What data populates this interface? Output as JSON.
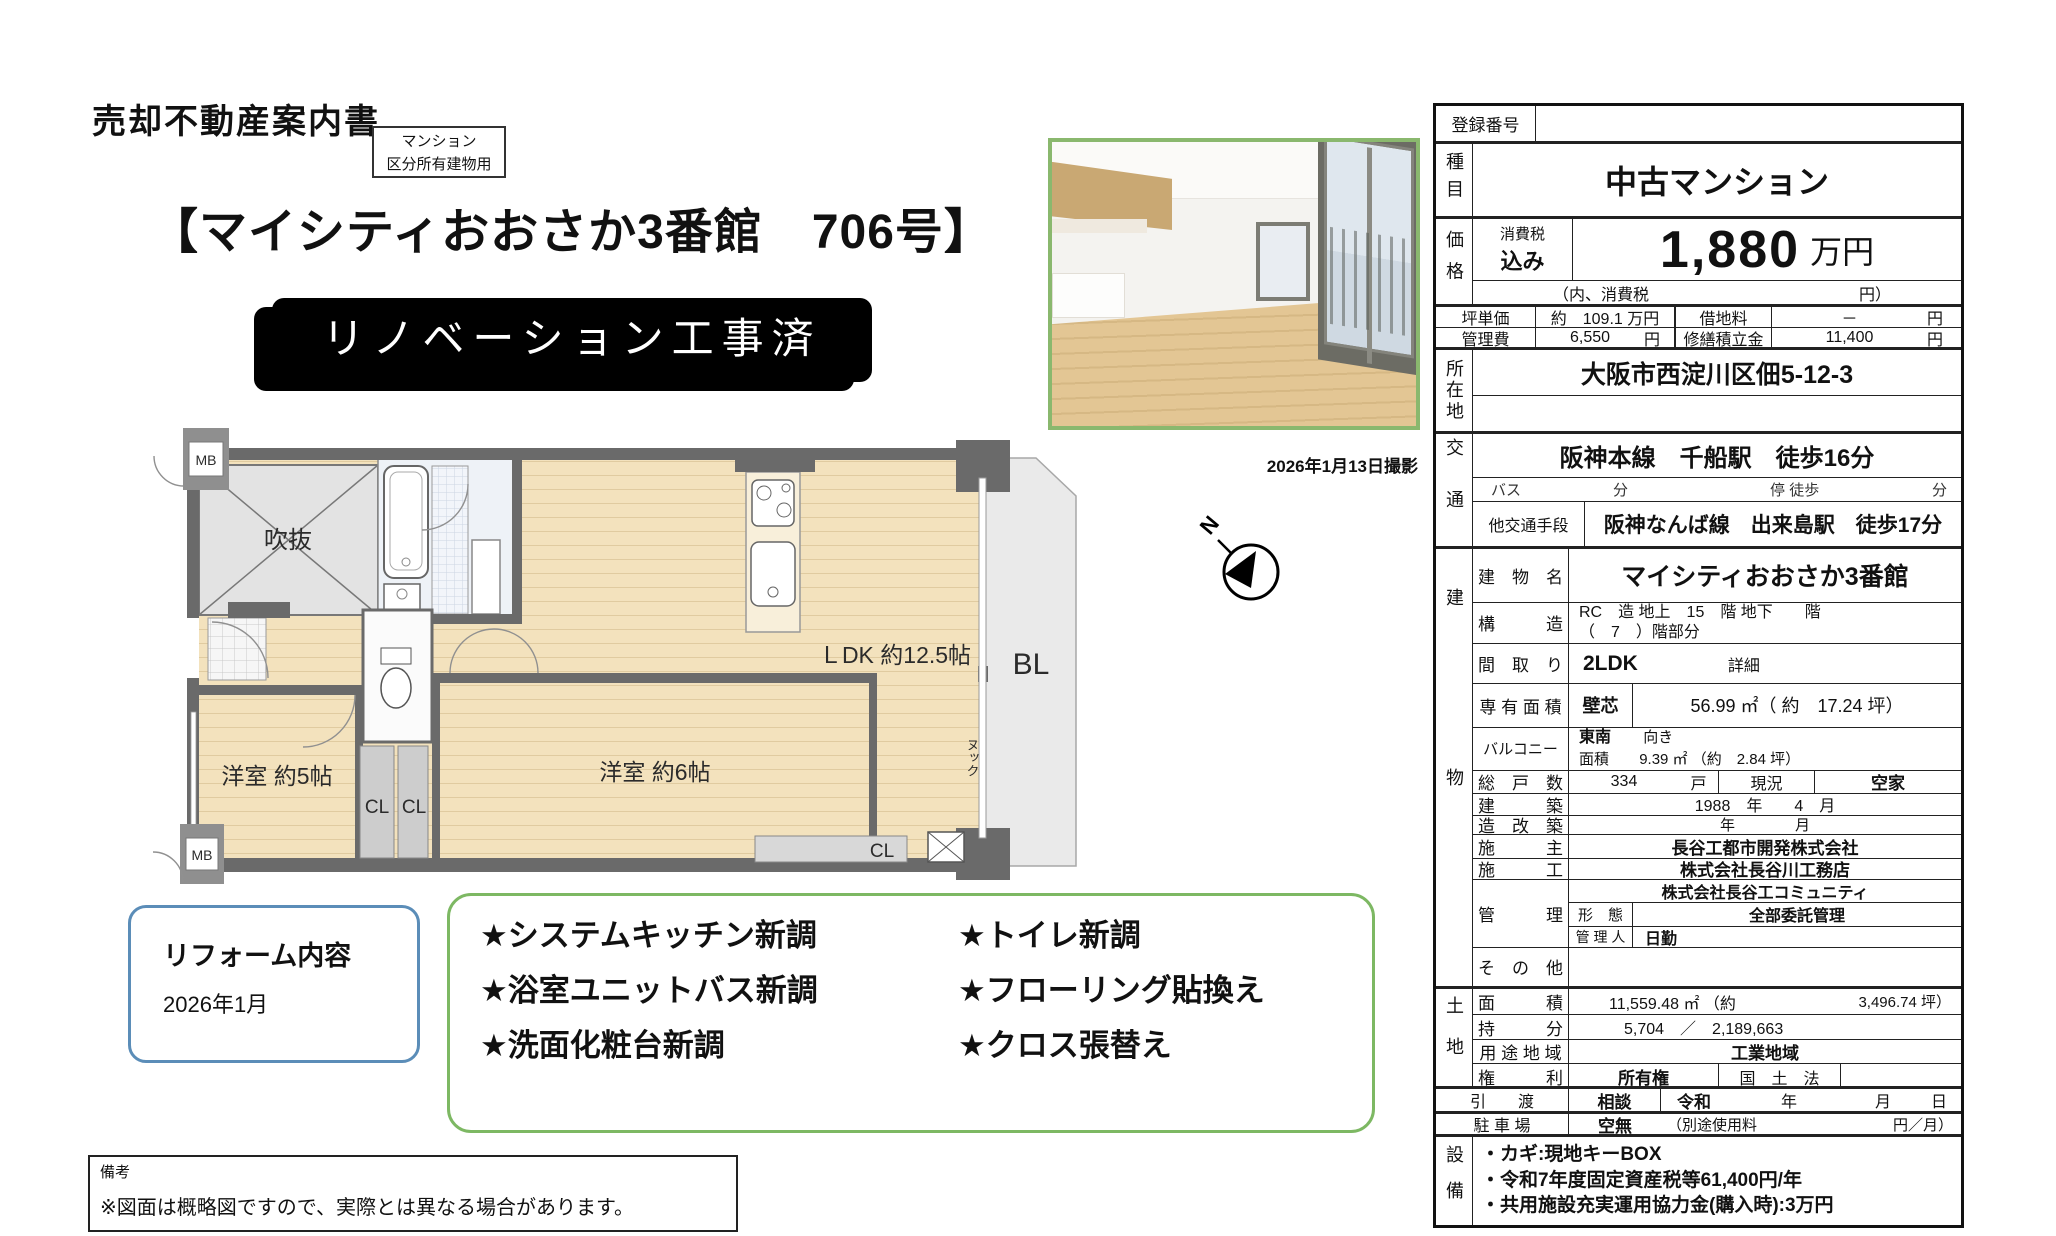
{
  "page": {
    "doc_title": "売却不動産案内書",
    "type_box": {
      "line1": "マンション",
      "line2": "区分所有建物用"
    },
    "heading": "【マイシティおおさか3番館　706号】",
    "banner": "リノベーション工事済",
    "photo_caption": "2026年1月13日撮影",
    "compass_n": "N"
  },
  "floorplan": {
    "labels": {
      "mb_top": "MB",
      "void": "吹抜",
      "bedroom5": "洋室 約5帖",
      "cl_left": "CL",
      "cl_right": "CL",
      "bedroom6": "洋室 約6帖",
      "ldk": "ＬDK 約12.5帖",
      "balcony": "BL",
      "nook": "ヌック",
      "cl_bottom": "CL",
      "mb_bottom": "MB"
    }
  },
  "reform": {
    "title": "リフォーム内容",
    "date": "2026年1月",
    "items": [
      "★システムキッチン新調",
      "★トイレ新調",
      "★浴室ユニットバス新調",
      "★フローリング貼換え",
      "★洗面化粧台新調",
      "★クロス張替え"
    ]
  },
  "remarks": {
    "label": "備考",
    "text": "※図面は概略図ですので、実際とは異なる場合があります。"
  },
  "table": {
    "registration": {
      "label": "登録番号",
      "value": ""
    },
    "category": {
      "label": "種目",
      "value": "中古マンション"
    },
    "price": {
      "label": "価格",
      "tax1": "消費税",
      "tax2": "込み",
      "value": "1,880",
      "unit": "万円",
      "note_left": "（内、消費税",
      "note_right": "円）"
    },
    "unit_price": {
      "label": "坪単価",
      "value": "約　109.1 万円"
    },
    "land_rent": {
      "label": "借地料",
      "value": "－",
      "unit": "円"
    },
    "mgmt_fee": {
      "label": "管理費",
      "value": "6,550",
      "unit": "円"
    },
    "repair_fund": {
      "label": "修繕積立金",
      "value": "11,400",
      "unit": "円"
    },
    "location": {
      "label": "所在地",
      "value": "大阪市西淀川区佃5-12-3"
    },
    "transport": {
      "label": "交通",
      "main": "阪神本線　千船駅　徒歩16分",
      "bus_label": "バス",
      "bus_min": "分",
      "bus_stop": "停 徒歩",
      "bus_stop_min": "分",
      "other_label": "他交通手段",
      "other": "阪神なんば線　出来島駅　徒歩17分"
    },
    "building": {
      "label": "建物",
      "name": {
        "label": "建　物　名",
        "value": "マイシティおおさか3番館"
      },
      "structure": {
        "label": "構　　　造",
        "line1": "RC　造 地上　15　階 地下　　階",
        "line2": "（　7　）階部分"
      },
      "layout": {
        "label": "間　取　り",
        "value": "2LDK",
        "detail": "詳細"
      },
      "area": {
        "label": "専 有 面 積",
        "method": "壁芯",
        "value": "56.99 ㎡（ 約　17.24 坪）"
      },
      "balcony": {
        "label": "バルコニー",
        "direction": "東南",
        "direction_suffix": "向き",
        "area_label": "面積",
        "area_value": "9.39 ㎡ （約　2.84 坪）"
      },
      "units": {
        "label": "総　戸　数",
        "value": "334",
        "unit": "戸",
        "status_label": "現況",
        "status_value": "空家"
      },
      "built": {
        "label": "建　　　築",
        "value": "1988　年　　4　月"
      },
      "rebuilt": {
        "label": "造　改　築",
        "value": "年　　　　月"
      },
      "developer": {
        "label": "施　　　主",
        "value": "長谷工都市開発株式会社"
      },
      "builder": {
        "label": "施　　　工",
        "value": "株式会社長谷川工務店"
      },
      "management": {
        "label": "管　　　理",
        "company": "株式会社長谷工コミュニティ",
        "form_label": "形　態",
        "form_value": "全部委託管理",
        "person_label": "管 理 人",
        "person_value": "日勤"
      },
      "other": {
        "label": "そ　の　他",
        "value": ""
      }
    },
    "land": {
      "label": "土地",
      "area": {
        "label": "面　　　積",
        "value": "11,559.48 ㎡ （約",
        "tsubo": "3,496.74 坪）"
      },
      "share": {
        "label": "持　　　分",
        "value": "5,704　／　2,189,663"
      },
      "zoning": {
        "label": "用 途 地 域",
        "value": "工業地域"
      },
      "rights": {
        "label": "権　　　利",
        "value": "所有権",
        "kokudo": "国　土　法"
      }
    },
    "handover": {
      "label": "引　　渡",
      "value": "相談",
      "era": "令和",
      "y": "年",
      "m": "月",
      "d": "日"
    },
    "parking": {
      "label": "駐 車 場",
      "value": "空無",
      "note_left": "（別途使用料",
      "note_right": "円／月）"
    },
    "equipment": {
      "label": "設備",
      "lines": [
        "・カギ:現地キーBOX",
        "・令和7年度固定資産税等61,400円/年",
        "・共用施設充実運用協力金(購入時):3万円"
      ]
    }
  }
}
